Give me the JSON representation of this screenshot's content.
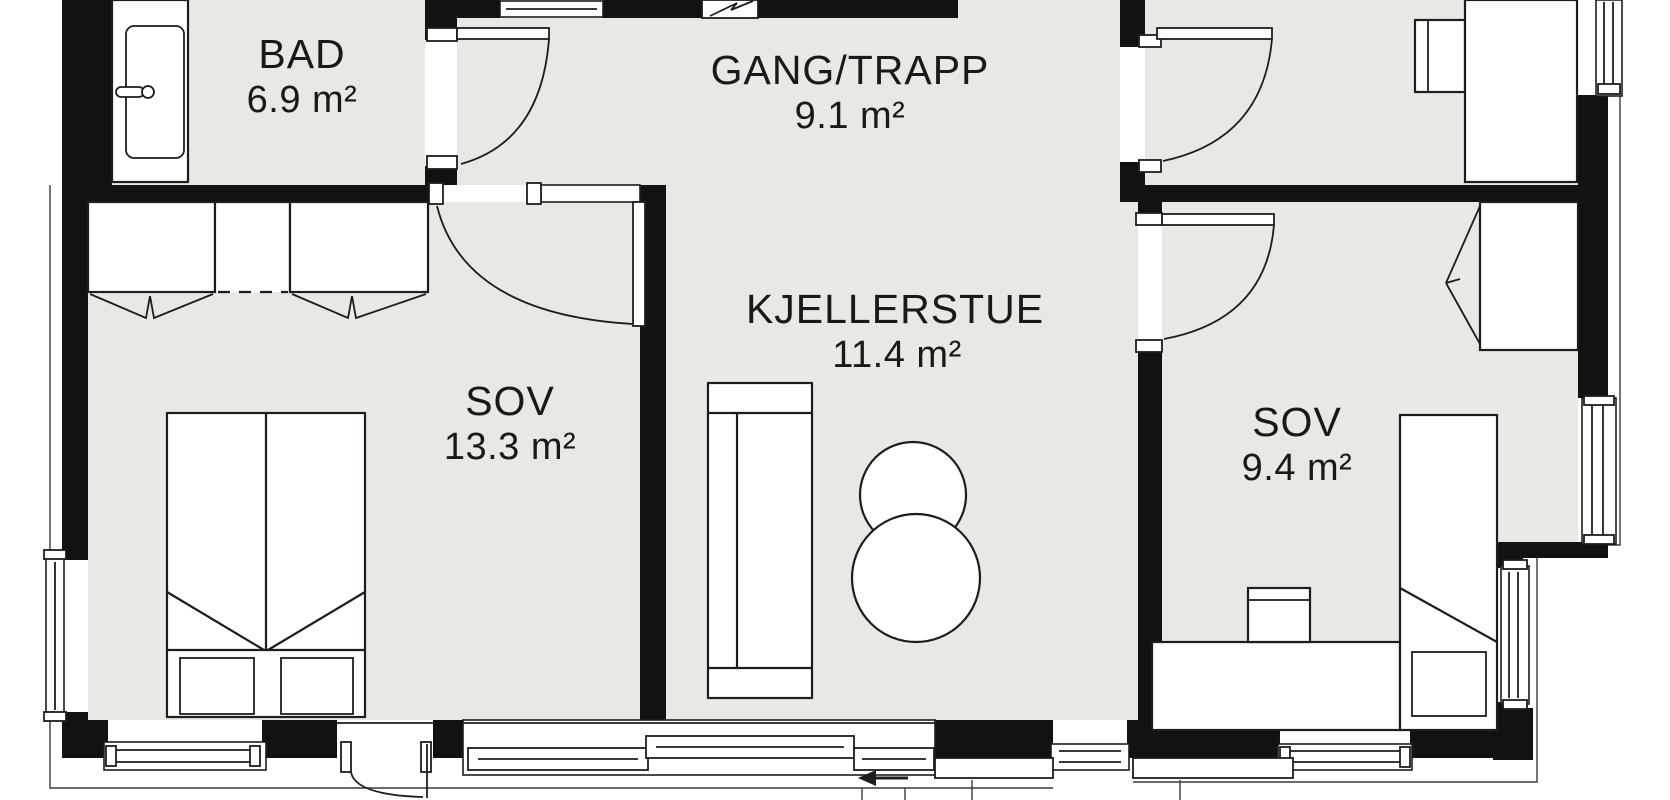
{
  "rooms": [
    {
      "id": "bad",
      "name": "BAD",
      "area": "6.9 m²"
    },
    {
      "id": "gang-trapp",
      "name": "GANG/TRAPP",
      "area": "9.1 m²"
    },
    {
      "id": "kjellerstue",
      "name": "KJELLERSTUE",
      "area": "11.4 m²"
    },
    {
      "id": "sov-left",
      "name": "SOV",
      "area": "13.3 m²"
    },
    {
      "id": "sov-right",
      "name": "SOV",
      "area": "9.4 m²"
    }
  ],
  "symbols": {
    "electrical_panel": "lightning-zigzag",
    "sliding_door_direction": "left"
  },
  "colors": {
    "wall": "#121212",
    "floor": "#e9e8e2",
    "background": "#ffffff",
    "line": "#1d1d1b",
    "text": "#191919"
  }
}
